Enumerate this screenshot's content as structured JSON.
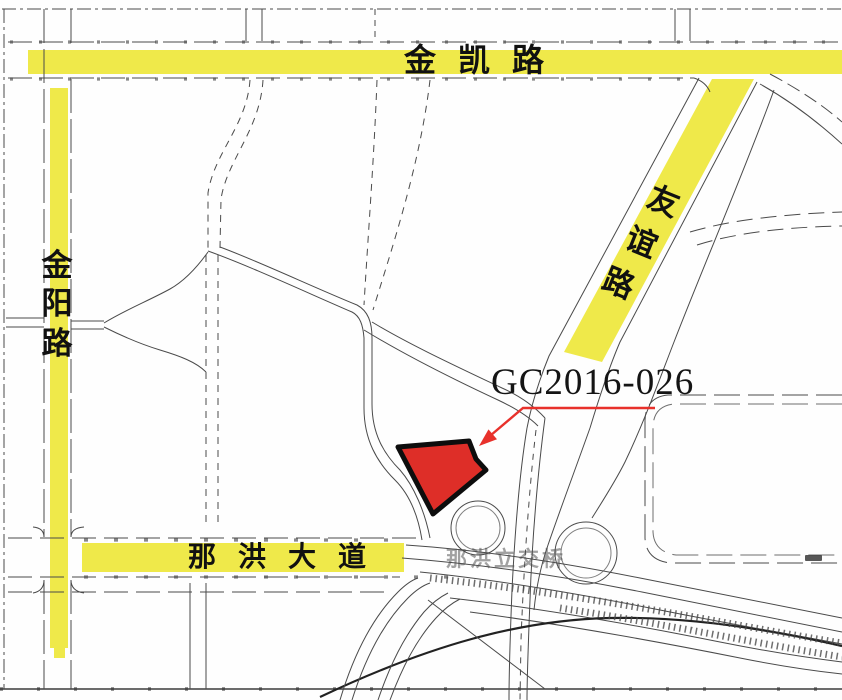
{
  "map": {
    "colors": {
      "highlight": "#EFE94A",
      "leader": "#E8312B",
      "line": "#4A4A4A"
    },
    "roads": {
      "jinkai_label": "金凯路",
      "jinyang_chars": [
        "金",
        "阳",
        "路"
      ],
      "youyi_chars": [
        "友",
        "谊",
        "路"
      ],
      "nahong_label": "那洪大道"
    },
    "parcel": {
      "code": "GC2016-026",
      "fill": "#DE2E28"
    },
    "interchange_label": "那洪立交桥"
  }
}
